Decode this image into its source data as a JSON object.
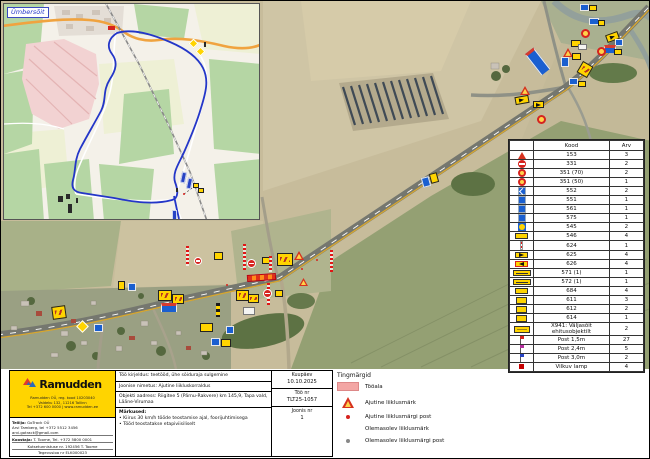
{
  "accent_colors": {
    "ramudden_yellow": "#ffd400",
    "work_area_pink": "#f3a6a4",
    "route_blue": "#2436c8",
    "sign_red": "#d6231e"
  },
  "inset": {
    "label": "Ümbersõit"
  },
  "sign_table": {
    "headers": {
      "icon": "",
      "code": "Kood",
      "qty": "Arv"
    },
    "rows": [
      {
        "icon": "tri",
        "code": "153",
        "qty": "3"
      },
      {
        "icon": "noentry",
        "code": "331",
        "qty": "2"
      },
      {
        "icon": "speed",
        "code": "351 (70)",
        "qty": "2"
      },
      {
        "icon": "speed",
        "code": "351 (50)",
        "qty": "1"
      },
      {
        "icon": "bluearr",
        "code": "552",
        "qty": "2"
      },
      {
        "icon": "blue",
        "code": "551",
        "qty": "1"
      },
      {
        "icon": "blue",
        "code": "561",
        "qty": "1"
      },
      {
        "icon": "blue",
        "code": "575",
        "qty": "1"
      },
      {
        "icon": "yb",
        "code": "545",
        "qty": "2"
      },
      {
        "icon": "ywide",
        "code": "546",
        "qty": "4"
      },
      {
        "icon": "post",
        "code": "624",
        "qty": "1"
      },
      {
        "icon": "arrr",
        "code": "625",
        "qty": "4"
      },
      {
        "icon": "arrl",
        "code": "626",
        "qty": "4"
      },
      {
        "icon": "board",
        "code": "571 (1)",
        "qty": "1"
      },
      {
        "icon": "board",
        "code": "572 (1)",
        "qty": "1"
      },
      {
        "icon": "ywide",
        "code": "684",
        "qty": "4"
      },
      {
        "icon": "ysm",
        "code": "611",
        "qty": "3"
      },
      {
        "icon": "ysm",
        "code": "612",
        "qty": "2"
      },
      {
        "icon": "ysm",
        "code": "614",
        "qty": "1"
      },
      {
        "icon": "ytext",
        "code": "X941: Väljasõit ehitusobjektilt",
        "qty": "2"
      },
      {
        "icon": "flag-red",
        "code": "Post 1,5m",
        "qty": "27"
      },
      {
        "icon": "flag-mag",
        "code": "Post 2,4m",
        "qty": "5"
      },
      {
        "icon": "flag-blue",
        "code": "Post 3,0m",
        "qty": "2"
      },
      {
        "icon": "lamp",
        "code": "Vilkuv lamp",
        "qty": "4"
      }
    ]
  },
  "legend": {
    "title": "Tingmärgid",
    "items": [
      {
        "swatch": "area",
        "label": "Tööala"
      },
      {
        "swatch": "tri",
        "label": "Ajutine liiklusmärk"
      },
      {
        "swatch": "dot-red",
        "label": "Ajutine liiklusmärgi post"
      },
      {
        "swatch": "tri-gray",
        "label": "Olemasolev liiklusmärk"
      },
      {
        "swatch": "dot-gray",
        "label": "Olemasolev liiklusmärgi post"
      }
    ]
  },
  "title_block": {
    "logo_text": "Ramudden",
    "logo_addr1": "Ramudden OÜ, reg. kood 10203040",
    "logo_addr2": "Valdeku 132, 11216 Tallinn",
    "logo_addr3": "Tel +372 600 0000  |  www.ramudden.ee",
    "client_label": "Tellija:",
    "client_line1": "GoTrack OÜ",
    "client_line2": "Arvi Tamberg, tel +372 5512 3456",
    "client_line3": "arvi.gotrack@gmail.com",
    "author_label": "Koostaja:",
    "author_line": "T. Toome, Tel. +372 5800 0001",
    "cert_line": "Kutsetunnistuse nr. 192456 T. Toome",
    "licence_line": "Tegevusloa nr ELK000023",
    "work_desc": "Töö kirjeldus: teetööd, ühe sõiduraja sulgemine",
    "drawing_name": "Joonise nimetus: Ajutine liikluskorraldus",
    "address": "Objekti aadress: Riigitee 5 (Pärnu-Rakvere) km 145,9, Tapa vald, Lääne-Virumaa",
    "notes_title": "Märkused:",
    "note1": "•  Kiirus 30 km/h tööde teostamise ajal, foorijuhtimisega",
    "note2": "•  Tööd teostatakse etapiviisiliselt",
    "date_label": "Kuupäev",
    "date_value": "10.10.2025",
    "job_label": "Töö nr",
    "job_value": "TLT25-1057",
    "sheet_label": "Joonis nr",
    "sheet_value": "1"
  },
  "map_markers": [
    {
      "t": "postline",
      "x": 242,
      "y": 243,
      "w": 3,
      "h": 26
    },
    {
      "t": "noentry",
      "x": 246,
      "y": 258,
      "w": 9,
      "h": 9
    },
    {
      "t": "yellow",
      "x": 261,
      "y": 256,
      "w": 8,
      "h": 7
    },
    {
      "t": "postline",
      "x": 268,
      "y": 255,
      "w": 3,
      "h": 16
    },
    {
      "t": "ylg",
      "x": 276,
      "y": 252,
      "w": 16,
      "h": 13
    },
    {
      "t": "tri",
      "x": 293,
      "y": 250,
      "w": 10,
      "h": 9
    },
    {
      "t": "work",
      "x": 246,
      "y": 273,
      "w": 29,
      "h": 7,
      "r": -4
    },
    {
      "t": "postline",
      "x": 266,
      "y": 282,
      "w": 3,
      "h": 22
    },
    {
      "t": "noentry",
      "x": 262,
      "y": 288,
      "w": 9,
      "h": 9
    },
    {
      "t": "yellow",
      "x": 274,
      "y": 289,
      "w": 8,
      "h": 7
    },
    {
      "t": "tri",
      "x": 298,
      "y": 277,
      "w": 9,
      "h": 8
    },
    {
      "t": "postline",
      "x": 329,
      "y": 249,
      "w": 3,
      "h": 22
    },
    {
      "t": "ylg",
      "x": 235,
      "y": 289,
      "w": 13,
      "h": 11
    },
    {
      "t": "ylg",
      "x": 247,
      "y": 293,
      "w": 11,
      "h": 9
    },
    {
      "t": "noentry",
      "x": 193,
      "y": 256,
      "w": 8,
      "h": 8
    },
    {
      "t": "postline",
      "x": 185,
      "y": 245,
      "w": 3,
      "h": 20
    },
    {
      "t": "yellow",
      "x": 213,
      "y": 251,
      "w": 9,
      "h": 8
    },
    {
      "t": "ylg",
      "x": 157,
      "y": 289,
      "w": 14,
      "h": 11
    },
    {
      "t": "ylg",
      "x": 171,
      "y": 293,
      "w": 12,
      "h": 10
    },
    {
      "t": "blue",
      "x": 127,
      "y": 282,
      "w": 8,
      "h": 8
    },
    {
      "t": "yellow",
      "x": 117,
      "y": 280,
      "w": 7,
      "h": 9
    },
    {
      "t": "dot",
      "x": 225,
      "y": 283,
      "w": 2,
      "h": 2
    },
    {
      "t": "dot",
      "x": 300,
      "y": 267,
      "w": 2,
      "h": 2
    },
    {
      "t": "dot",
      "x": 315,
      "y": 258,
      "w": 2,
      "h": 2
    },
    {
      "t": "ylg",
      "x": 51,
      "y": 305,
      "w": 14,
      "h": 13,
      "r": -8
    },
    {
      "t": "diamond",
      "x": 77,
      "y": 321,
      "w": 9,
      "h": 9
    },
    {
      "t": "blue",
      "x": 93,
      "y": 323,
      "w": 9,
      "h": 8
    },
    {
      "t": "info",
      "x": 160,
      "y": 302,
      "w": 16,
      "h": 9
    },
    {
      "t": "postbw",
      "x": 215,
      "y": 302,
      "w": 4,
      "h": 14
    },
    {
      "t": "white",
      "x": 242,
      "y": 306,
      "w": 12,
      "h": 8
    },
    {
      "t": "yellow",
      "x": 199,
      "y": 322,
      "w": 13,
      "h": 9
    },
    {
      "t": "blue",
      "x": 225,
      "y": 325,
      "w": 8,
      "h": 8
    },
    {
      "t": "blue",
      "x": 210,
      "y": 337,
      "w": 9,
      "h": 8
    },
    {
      "t": "yellow",
      "x": 220,
      "y": 338,
      "w": 10,
      "h": 8
    },
    {
      "t": "blue",
      "x": 421,
      "y": 176,
      "w": 8,
      "h": 10,
      "r": -15
    },
    {
      "t": "yellow",
      "x": 429,
      "y": 172,
      "w": 8,
      "h": 10,
      "r": -15
    },
    {
      "t": "tri",
      "x": 519,
      "y": 85,
      "w": 10,
      "h": 9
    },
    {
      "t": "arrow",
      "x": 514,
      "y": 95,
      "w": 14,
      "h": 8,
      "r": -10
    },
    {
      "t": "arrow",
      "x": 532,
      "y": 100,
      "w": 11,
      "h": 7
    },
    {
      "t": "speed",
      "x": 536,
      "y": 114,
      "w": 9,
      "h": 9
    },
    {
      "t": "info",
      "x": 531,
      "y": 47,
      "w": 11,
      "h": 27,
      "r": -38
    },
    {
      "t": "blue",
      "x": 579,
      "y": 3,
      "w": 9,
      "h": 7
    },
    {
      "t": "yellow",
      "x": 588,
      "y": 4,
      "w": 8,
      "h": 6
    },
    {
      "t": "blue",
      "x": 588,
      "y": 17,
      "w": 10,
      "h": 7
    },
    {
      "t": "yellow",
      "x": 597,
      "y": 19,
      "w": 7,
      "h": 6
    },
    {
      "t": "speed",
      "x": 580,
      "y": 28,
      "w": 9,
      "h": 9
    },
    {
      "t": "arrow",
      "x": 605,
      "y": 32,
      "w": 13,
      "h": 8,
      "r": -20
    },
    {
      "t": "blue",
      "x": 614,
      "y": 38,
      "w": 8,
      "h": 7
    },
    {
      "t": "info",
      "x": 603,
      "y": 44,
      "w": 12,
      "h": 8
    },
    {
      "t": "yellow",
      "x": 613,
      "y": 48,
      "w": 8,
      "h": 6
    },
    {
      "t": "speed",
      "x": 596,
      "y": 46,
      "w": 9,
      "h": 9
    },
    {
      "t": "yellow",
      "x": 570,
      "y": 39,
      "w": 10,
      "h": 7
    },
    {
      "t": "white",
      "x": 577,
      "y": 43,
      "w": 9,
      "h": 6
    },
    {
      "t": "tri",
      "x": 562,
      "y": 47,
      "w": 10,
      "h": 9
    },
    {
      "t": "yellow",
      "x": 571,
      "y": 52,
      "w": 9,
      "h": 7
    },
    {
      "t": "blue",
      "x": 560,
      "y": 56,
      "w": 8,
      "h": 10
    },
    {
      "t": "ylg",
      "x": 578,
      "y": 62,
      "w": 12,
      "h": 13,
      "r": 30
    },
    {
      "t": "blue",
      "x": 568,
      "y": 77,
      "w": 9,
      "h": 7
    },
    {
      "t": "yellow",
      "x": 577,
      "y": 80,
      "w": 8,
      "h": 6
    }
  ],
  "inset_markers": [
    {
      "t": "red",
      "x": 104,
      "y": 22,
      "w": 7,
      "h": 4
    },
    {
      "t": "diamond",
      "x": 186,
      "y": 36,
      "w": 7,
      "h": 7
    },
    {
      "t": "diamond",
      "x": 193,
      "y": 44,
      "w": 7,
      "h": 7
    },
    {
      "t": "dark",
      "x": 200,
      "y": 38,
      "w": 2,
      "h": 5
    },
    {
      "t": "bluev",
      "x": 177,
      "y": 168,
      "w": 5,
      "h": 11,
      "r": 12
    },
    {
      "t": "bluev",
      "x": 183,
      "y": 174,
      "w": 5,
      "h": 11,
      "r": 12
    },
    {
      "t": "yellow",
      "x": 189,
      "y": 179,
      "w": 6,
      "h": 5
    },
    {
      "t": "yellow",
      "x": 194,
      "y": 184,
      "w": 6,
      "h": 5
    },
    {
      "t": "dark",
      "x": 172,
      "y": 184,
      "w": 2,
      "h": 4
    },
    {
      "t": "dot",
      "x": 179,
      "y": 189,
      "w": 2,
      "h": 2
    },
    {
      "t": "dark",
      "x": 54,
      "y": 192,
      "w": 5,
      "h": 6
    },
    {
      "t": "dark",
      "x": 62,
      "y": 190,
      "w": 4,
      "h": 5
    },
    {
      "t": "dark",
      "x": 72,
      "y": 194,
      "w": 2,
      "h": 5
    },
    {
      "t": "bluev",
      "x": 168,
      "y": 206,
      "w": 5,
      "h": 10
    },
    {
      "t": "dark",
      "x": 64,
      "y": 200,
      "w": 4,
      "h": 9
    }
  ]
}
